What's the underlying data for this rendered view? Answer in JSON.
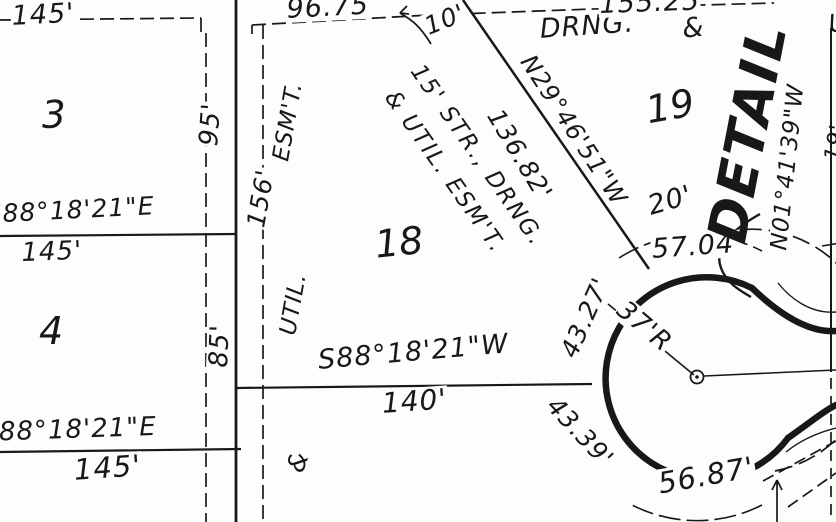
{
  "page": {
    "type": "plat-survey-map-scan",
    "paper_color": "#fdfdfb",
    "ink_color": "#181818"
  },
  "lots": {
    "lot3": "3",
    "lot4": "4",
    "lot18": "18",
    "lot19": "19"
  },
  "bearings": {
    "west_upper": "S88°18'21\"E",
    "west_lower": "S88°18'21\"E",
    "south_lot18": "S88°18'21\"W",
    "diagonal": "N29°46'51\"W",
    "east": "N01°41'39\"W"
  },
  "dimensions": {
    "top_left": "145'",
    "west_upper_dist": "145'",
    "west_lower_dist": "145'",
    "lot3_depth": "95'",
    "lot4_depth": "85'",
    "easement_length": "156'",
    "top_mid": "96.75",
    "top_right": "155.25",
    "offset_10": "10'",
    "diagonal_dist": "136.82'",
    "south_lot18_dist": "140'",
    "gap_20": "20'",
    "arc_ne": "57.04'",
    "arc_nw": "43.27'",
    "culdesac_radius": "37'R",
    "arc_sw": "43.39'",
    "arc_s": "56.87'",
    "edge_partial": "19'"
  },
  "easements": {
    "left_col_esmt": "ESM'T.",
    "left_col_dim_label": "156'",
    "left_col_util": "UTIL.",
    "left_col_amp": "&",
    "diag_line1": "15' STR., DRNG.",
    "diag_line2": "& UTIL. ESM'T.",
    "top_drng": "DRNG.",
    "top_amp": "&",
    "top_partial": "U"
  },
  "annotations": {
    "detail": "DETAIL"
  }
}
